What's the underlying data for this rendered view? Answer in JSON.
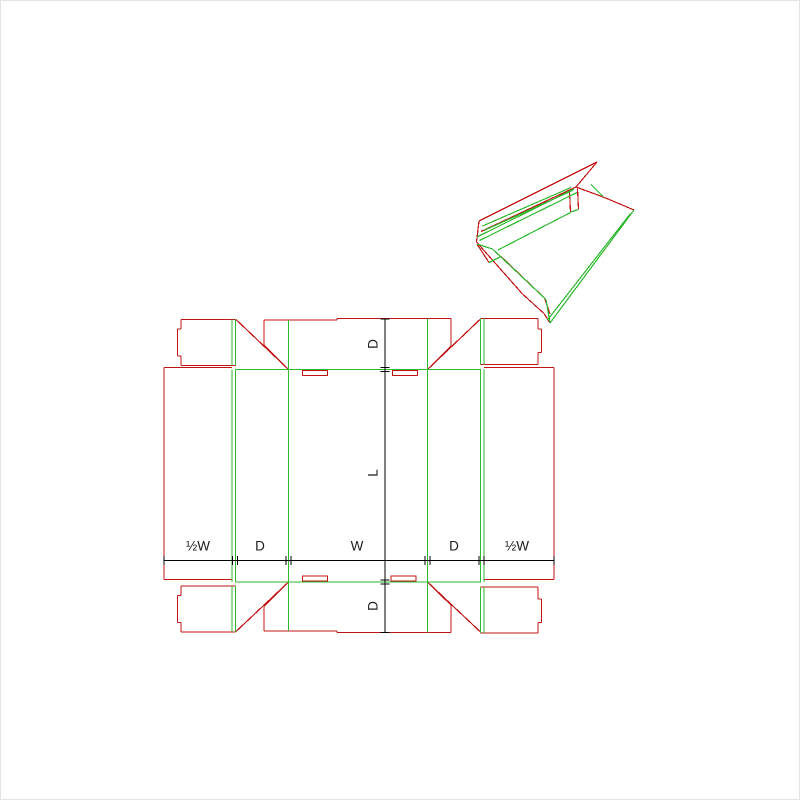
{
  "page": {
    "description": "Flat dieline drawing of a fold-over tray box with gusset corners, with a 3D preview of the partially folded box in the upper right",
    "background": "#ffffff",
    "border_color": "#e3e3e3"
  },
  "colors": {
    "cut": "#c21414",
    "fold": "#2db82d",
    "dimension": "#000000",
    "text": "#1a1a1a"
  },
  "dimension_labels": {
    "horizontal": [
      {
        "text": "½W",
        "x": 197,
        "y": 545
      },
      {
        "text": "D",
        "x": 259,
        "y": 545
      },
      {
        "text": "W",
        "x": 356,
        "y": 545
      },
      {
        "text": "D",
        "x": 453,
        "y": 545
      },
      {
        "text": "½W",
        "x": 516,
        "y": 545
      }
    ],
    "vertical": [
      {
        "text": "D",
        "x": 372,
        "y": 343
      },
      {
        "text": "L",
        "x": 372,
        "y": 472
      },
      {
        "text": "D",
        "x": 372,
        "y": 605
      }
    ]
  },
  "dimension_lines": {
    "horizontal": {
      "y": 559.5,
      "x1": 163,
      "x2": 553,
      "ticks": [
        163,
        231.5,
        236.5,
        285,
        290,
        424,
        429,
        478,
        483,
        553
      ]
    },
    "vertical": {
      "x": 384,
      "y1": 318,
      "y2": 631.5,
      "ticks": [
        318,
        366.5,
        370.5,
        579,
        583,
        631.5
      ]
    }
  },
  "flat_dieline": {
    "slot_rects": [
      [
        301.5,
        369.5,
        25,
        5
      ],
      [
        391.5,
        369.5,
        25,
        5
      ],
      [
        301.5,
        575,
        25,
        5
      ],
      [
        390,
        575,
        25,
        5
      ]
    ],
    "cut_segments": [
      [
        180,
        318.5,
        231,
        318.5
      ],
      [
        180,
        318.5,
        180,
        328
      ],
      [
        180,
        328,
        176.5,
        328
      ],
      [
        176.5,
        328,
        176.5,
        355
      ],
      [
        176.5,
        355,
        180,
        355
      ],
      [
        180,
        355,
        180,
        364.5
      ],
      [
        180,
        364.5,
        231,
        364.5
      ],
      [
        231,
        318.5,
        234.5,
        318.5
      ],
      [
        231,
        364.5,
        234.5,
        364.5
      ],
      [
        235,
        318.5,
        287.5,
        368.5
      ],
      [
        263,
        319,
        336,
        319
      ],
      [
        336,
        319,
        336,
        317.5
      ],
      [
        336,
        317.5,
        450,
        317.5
      ],
      [
        263,
        319,
        263,
        344
      ],
      [
        263,
        344,
        287.5,
        368.5
      ],
      [
        450,
        317.5,
        450,
        345
      ],
      [
        450,
        345,
        426.5,
        368.5
      ],
      [
        480,
        317.5,
        426.5,
        368.5
      ],
      [
        479.5,
        317.5,
        483,
        317.5
      ],
      [
        479.5,
        363.5,
        483,
        363.5
      ],
      [
        483,
        317.5,
        537,
        317.5
      ],
      [
        537,
        317.5,
        537,
        328
      ],
      [
        537,
        328,
        540.5,
        328
      ],
      [
        540.5,
        328,
        540.5,
        351.5
      ],
      [
        540.5,
        351.5,
        537,
        351.5
      ],
      [
        537,
        351.5,
        537,
        363.5
      ],
      [
        537,
        363.5,
        483,
        363.5
      ],
      [
        163,
        366.5,
        231,
        366.5
      ],
      [
        163,
        366.5,
        163,
        578.5
      ],
      [
        163,
        578.5,
        231,
        578.5
      ],
      [
        483,
        366.5,
        553,
        366.5
      ],
      [
        553,
        366.5,
        553,
        578.5
      ],
      [
        483,
        578.5,
        553,
        578.5
      ],
      [
        263,
        630,
        336,
        630
      ],
      [
        336,
        630,
        336,
        631.5
      ],
      [
        336,
        631.5,
        450,
        631.5
      ],
      [
        263,
        630,
        263,
        605.5
      ],
      [
        263,
        605.5,
        287.5,
        581
      ],
      [
        450,
        631.5,
        450,
        604
      ],
      [
        450,
        604,
        426.5,
        581
      ],
      [
        235,
        630.5,
        287.5,
        581
      ],
      [
        480,
        631.5,
        426.5,
        581
      ],
      [
        180,
        585,
        231,
        585
      ],
      [
        180,
        585,
        180,
        594.5
      ],
      [
        180,
        594.5,
        176.5,
        594.5
      ],
      [
        176.5,
        594.5,
        176.5,
        621.5
      ],
      [
        176.5,
        621.5,
        180,
        621.5
      ],
      [
        180,
        621.5,
        180,
        631
      ],
      [
        180,
        631,
        231,
        631
      ],
      [
        231,
        585,
        234.5,
        585
      ],
      [
        231,
        631,
        234.5,
        631
      ],
      [
        483,
        586,
        537,
        586
      ],
      [
        537,
        586,
        537,
        598
      ],
      [
        537,
        598,
        540.5,
        598
      ],
      [
        540.5,
        598,
        540.5,
        621.5
      ],
      [
        540.5,
        621.5,
        537,
        621.5
      ],
      [
        537,
        621.5,
        537,
        632
      ],
      [
        537,
        632,
        483,
        632
      ],
      [
        479.5,
        586,
        483,
        586
      ],
      [
        479.5,
        632,
        483,
        632
      ]
    ],
    "fold_segments": [
      [
        231,
        318.5,
        231,
        364.5
      ],
      [
        234.5,
        318.5,
        234.5,
        364.5
      ],
      [
        287.5,
        319,
        287.5,
        368.5
      ],
      [
        426.5,
        317.5,
        426.5,
        368.5
      ],
      [
        479.5,
        317.5,
        479.5,
        363.5
      ],
      [
        483,
        317.5,
        483,
        363.5
      ],
      [
        234.5,
        368.5,
        480,
        368.5
      ],
      [
        231,
        368.5,
        231,
        581
      ],
      [
        234.5,
        368.5,
        234.5,
        581
      ],
      [
        287.5,
        368.5,
        287.5,
        581
      ],
      [
        426.5,
        368.5,
        426.5,
        581
      ],
      [
        479.5,
        368.5,
        479.5,
        581
      ],
      [
        483,
        368.5,
        483,
        581
      ],
      [
        234.5,
        581,
        480,
        581
      ],
      [
        287.5,
        581,
        287.5,
        630
      ],
      [
        426.5,
        581,
        426.5,
        631.5
      ],
      [
        231,
        585,
        231,
        631
      ],
      [
        234.5,
        585,
        234.5,
        631
      ],
      [
        479.5,
        586,
        479.5,
        632
      ],
      [
        483,
        586,
        483,
        632
      ]
    ]
  },
  "folded_preview": {
    "cut_segments": [
      [
        596,
        161,
        478,
        220
      ],
      [
        596,
        161,
        575,
        186
      ],
      [
        575,
        186,
        480,
        230.5
      ],
      [
        478,
        220,
        475.5,
        241
      ],
      [
        475.5,
        241,
        521.5,
        293
      ],
      [
        521.5,
        293,
        543,
        312.5
      ],
      [
        543,
        312.5,
        549,
        322
      ],
      [
        476,
        243,
        488,
        261.5
      ],
      [
        500,
        255.5,
        543.5,
        297
      ],
      [
        543.5,
        297,
        549,
        313
      ],
      [
        603.5,
        196.5,
        633,
        209
      ],
      [
        575,
        186,
        603.5,
        196.5
      ],
      [
        568.5,
        190,
        569.5,
        211
      ],
      [
        576.5,
        187.5,
        577.5,
        208.5
      ]
    ],
    "fold_segments": [
      [
        573,
        188,
        476,
        236
      ],
      [
        576,
        191.5,
        478.5,
        239.5
      ],
      [
        481.5,
        225,
        570,
        186.5
      ],
      [
        483,
        229.5,
        571.5,
        189.5
      ],
      [
        476,
        243,
        491.5,
        248
      ],
      [
        488,
        261.5,
        500,
        255.5
      ],
      [
        491.5,
        248,
        545,
        298.5
      ],
      [
        545,
        298.5,
        549,
        322
      ],
      [
        549,
        322,
        633,
        209
      ],
      [
        546.5,
        319,
        629.5,
        212.5
      ],
      [
        590,
        183.5,
        602.5,
        196
      ],
      [
        569.5,
        211,
        577.5,
        208.5
      ],
      [
        497,
        249,
        569.5,
        211.5
      ]
    ]
  }
}
